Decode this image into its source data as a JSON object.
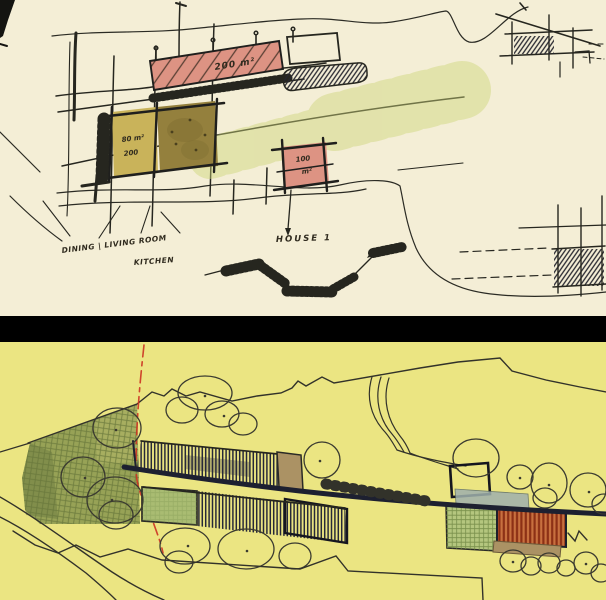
{
  "scene": {
    "description": "Two stacked hand-drawn architectural site-plan sketches separated by a black band"
  },
  "top_sketch": {
    "paper_color": "#f4eed6",
    "labels": {
      "bar_area": "200 m²",
      "room_area_line1": "80 m²",
      "room_area_line2": "200",
      "house_area_line1": "100",
      "house_area_line2": "m²",
      "house_label": "HOUSE 1",
      "program_label_line1": "DINING | LIVING ROOM",
      "program_label_line2": "KITCHEN"
    },
    "colors": {
      "building_pink": "#dd9383",
      "room_olive_light": "#c9b35a",
      "room_olive_dark": "#94803d",
      "marker_green": "#cdd478",
      "ink": "#2b2b24"
    }
  },
  "divider": {
    "color": "#000000"
  },
  "bottom_sketch": {
    "paper_color": "#ebe582",
    "colors": {
      "vegetation_green": "#8f9c52",
      "lawn_green": "#a9bc72",
      "court_green": "#b4c67e",
      "roof_orange": "#c8703f",
      "deck_tan": "#ab9264",
      "pool_grey": "#9fb0ad",
      "road_ink": "#1d2030",
      "red_guide": "#cc3322"
    }
  }
}
